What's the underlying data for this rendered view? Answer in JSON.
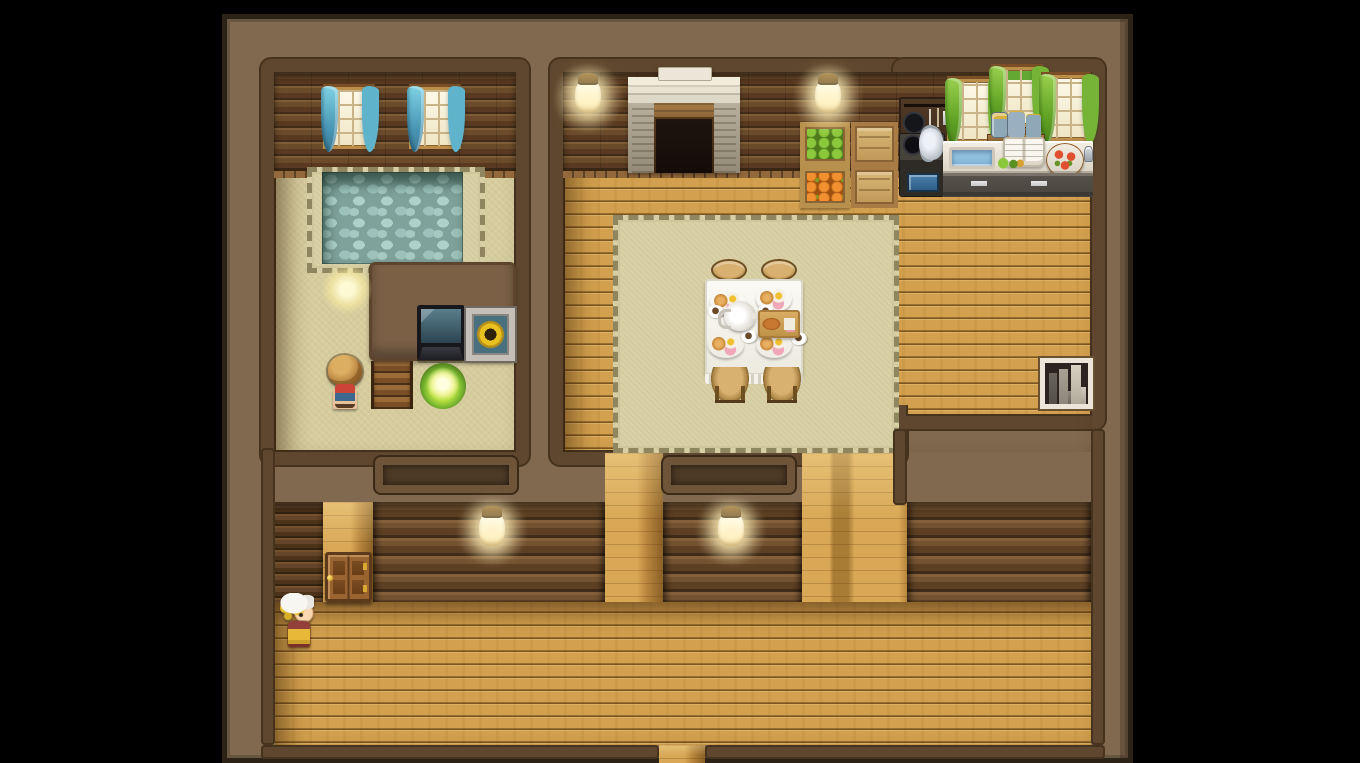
{
  "meta": {
    "app": "rpg-maker-style-game",
    "view": "cottage-interior-map",
    "visible_text": [],
    "hud": "none"
  },
  "palette": {
    "letterbox": "#000000",
    "wall_top": "#80694f",
    "room_border": "#5e472e",
    "log_wall": "#6b4b2a",
    "wood_floor": "#c9953f",
    "beige_floor": "#d6cc9e",
    "rug": "#d9d0a6",
    "pool_water": "#9cc2bb",
    "curtain_blue": "#5fb4cc",
    "curtain_green": "#76b438",
    "lamp_glow": "#ffeeb4",
    "fire": "#ff9820",
    "door_wood": "#9a6430",
    "tablecloth": "#f4f2ec"
  },
  "rooms": [
    {
      "name": "bath-living-room",
      "features": [
        "stone-pool",
        "blue-curtain-windows",
        "tv",
        "sunflower-picture",
        "stairs",
        "glowing-bush",
        "light-orb"
      ]
    },
    {
      "name": "dining-kitchen-room",
      "features": [
        "fireplace",
        "dining-table",
        "kitchen-counter",
        "produce-crates",
        "green-curtain-windows",
        "bookshelf"
      ]
    },
    {
      "name": "south-corridor",
      "features": [
        "wooden-door",
        "wall-lamps",
        "transom-openings",
        "exit-passage-south"
      ]
    }
  ],
  "objects": [
    {
      "name": "light-orb",
      "sprite": "glow-orb",
      "x": 94,
      "y": 244,
      "w": 52,
      "h": 52,
      "interactable": false
    },
    {
      "name": "window-blue-1",
      "sprite": "window-blue",
      "x": 96,
      "y": 68,
      "w": 52,
      "h": 62,
      "interactable": false
    },
    {
      "name": "window-blue-2",
      "sprite": "window-blue",
      "x": 182,
      "y": 68,
      "w": 52,
      "h": 62,
      "interactable": false
    },
    {
      "name": "tv",
      "sprite": "tv",
      "x": 190,
      "y": 286,
      "w": 48,
      "h": 55,
      "interactable": true
    },
    {
      "name": "sunflower-picture",
      "sprite": "picture",
      "x": 239,
      "y": 289,
      "w": 49,
      "h": 53,
      "interactable": false
    },
    {
      "name": "stairs-down",
      "sprite": "stairs",
      "x": 144,
      "y": 342,
      "w": 42,
      "h": 48,
      "interactable": true
    },
    {
      "name": "glowing-bush",
      "sprite": "bush-light",
      "x": 193,
      "y": 344,
      "w": 46,
      "h": 46,
      "interactable": false
    },
    {
      "name": "fireplace",
      "sprite": "fireplace",
      "x": 401,
      "y": 48,
      "w": 112,
      "h": 106,
      "interactable": false
    },
    {
      "name": "crate-apples",
      "sprite": "crate-apples",
      "x": 573,
      "y": 103,
      "w": 50,
      "h": 44,
      "interactable": false
    },
    {
      "name": "crate-plain-1",
      "sprite": "crate-wood",
      "x": 624,
      "y": 103,
      "w": 47,
      "h": 44,
      "interactable": false
    },
    {
      "name": "crate-carrots",
      "sprite": "crate-carrots",
      "x": 573,
      "y": 147,
      "w": 50,
      "h": 42,
      "interactable": false
    },
    {
      "name": "crate-plain-2",
      "sprite": "crate-wood",
      "x": 624,
      "y": 147,
      "w": 47,
      "h": 42,
      "interactable": false
    },
    {
      "name": "pot-rack",
      "sprite": "pot-rack",
      "x": 672,
      "y": 78,
      "w": 50,
      "h": 52,
      "interactable": false
    },
    {
      "name": "stove-with-kettle",
      "sprite": "stove",
      "x": 672,
      "y": 114,
      "w": 46,
      "h": 64,
      "interactable": false
    },
    {
      "name": "window-green-1",
      "sprite": "window-green",
      "x": 720,
      "y": 60,
      "w": 50,
      "h": 64,
      "interactable": false
    },
    {
      "name": "window-green-middle",
      "sprite": "window-green-high",
      "x": 764,
      "y": 48,
      "w": 52,
      "h": 60,
      "interactable": false
    },
    {
      "name": "window-green-2",
      "sprite": "window-green",
      "x": 814,
      "y": 56,
      "w": 50,
      "h": 66,
      "interactable": false
    },
    {
      "name": "jar-shelf",
      "sprite": "shelf-jars",
      "x": 760,
      "y": 86,
      "w": 58,
      "h": 40,
      "interactable": false
    },
    {
      "name": "kitchen-counter-top",
      "sprite": "counter-top",
      "x": 716,
      "y": 122,
      "w": 150,
      "h": 34,
      "interactable": false
    },
    {
      "name": "sink-basin",
      "sprite": "sink",
      "x": 722,
      "y": 128,
      "w": 46,
      "h": 22,
      "interactable": false
    },
    {
      "name": "open-cookbook",
      "sprite": "cookbook",
      "x": 776,
      "y": 118,
      "w": 42,
      "h": 30,
      "interactable": false
    },
    {
      "name": "veggie-plate",
      "sprite": "veggie-plate",
      "x": 766,
      "y": 138,
      "w": 34,
      "h": 14,
      "interactable": false
    },
    {
      "name": "pizza",
      "sprite": "pizza",
      "x": 819,
      "y": 124,
      "w": 38,
      "h": 34,
      "interactable": false
    },
    {
      "name": "salt-shaker",
      "sprite": "shaker",
      "x": 857,
      "y": 127,
      "w": 9,
      "h": 16,
      "interactable": false
    },
    {
      "name": "kitchen-counter-base",
      "sprite": "counter-base",
      "x": 716,
      "y": 154,
      "w": 150,
      "h": 24,
      "interactable": false
    },
    {
      "name": "stool-top-left",
      "sprite": "stool-top",
      "x": 484,
      "y": 240,
      "w": 36,
      "h": 22,
      "interactable": false
    },
    {
      "name": "stool-top-right",
      "sprite": "stool-top",
      "x": 534,
      "y": 240,
      "w": 36,
      "h": 22,
      "interactable": false
    },
    {
      "name": "dining-table",
      "sprite": "table-cloth",
      "x": 478,
      "y": 260,
      "w": 98,
      "h": 96,
      "interactable": true
    },
    {
      "name": "meal-plate-1",
      "sprite": "plate-meal",
      "x": 483,
      "y": 270,
      "w": 36,
      "h": 26,
      "interactable": false
    },
    {
      "name": "meal-plate-2",
      "sprite": "plate-meal",
      "x": 529,
      "y": 267,
      "w": 36,
      "h": 26,
      "interactable": false
    },
    {
      "name": "meal-plate-3",
      "sprite": "plate-meal",
      "x": 481,
      "y": 313,
      "w": 36,
      "h": 26,
      "interactable": false
    },
    {
      "name": "meal-plate-4",
      "sprite": "plate-meal",
      "x": 529,
      "y": 313,
      "w": 36,
      "h": 26,
      "interactable": false
    },
    {
      "name": "coffee-cup-1",
      "sprite": "cup",
      "x": 480,
      "y": 286,
      "w": 17,
      "h": 13,
      "interactable": false
    },
    {
      "name": "coffee-cup-2",
      "sprite": "cup",
      "x": 530,
      "y": 286,
      "w": 17,
      "h": 13,
      "interactable": false
    },
    {
      "name": "coffee-cup-3",
      "sprite": "cup",
      "x": 513,
      "y": 311,
      "w": 17,
      "h": 13,
      "interactable": false
    },
    {
      "name": "coffee-cup-4",
      "sprite": "cup",
      "x": 563,
      "y": 313,
      "w": 17,
      "h": 13,
      "interactable": false
    },
    {
      "name": "teapot",
      "sprite": "teapot",
      "x": 497,
      "y": 282,
      "w": 32,
      "h": 30,
      "interactable": false
    },
    {
      "name": "cutting-board-bread",
      "sprite": "cutting-board",
      "x": 531,
      "y": 291,
      "w": 42,
      "h": 28,
      "interactable": false
    },
    {
      "name": "stool-bottom-left",
      "sprite": "stool-bottom",
      "x": 484,
      "y": 348,
      "w": 38,
      "h": 36,
      "interactable": false
    },
    {
      "name": "stool-bottom-right",
      "sprite": "stool-bottom",
      "x": 536,
      "y": 348,
      "w": 38,
      "h": 36,
      "interactable": false
    },
    {
      "name": "bookshelf",
      "sprite": "bookshelf",
      "x": 813,
      "y": 339,
      "w": 53,
      "h": 51,
      "interactable": true
    },
    {
      "name": "wooden-door",
      "sprite": "door",
      "x": 98,
      "y": 533,
      "w": 47,
      "h": 50,
      "interactable": true
    },
    {
      "name": "wall-lamp-1",
      "sprite": "lamp",
      "x": 348,
      "y": 62,
      "w": 26,
      "h": 32,
      "interactable": false
    },
    {
      "name": "wall-lamp-2",
      "sprite": "lamp",
      "x": 588,
      "y": 62,
      "w": 26,
      "h": 32,
      "interactable": false
    },
    {
      "name": "wall-lamp-3",
      "sprite": "lamp",
      "x": 252,
      "y": 495,
      "w": 26,
      "h": 32,
      "interactable": false
    },
    {
      "name": "wall-lamp-4",
      "sprite": "lamp",
      "x": 491,
      "y": 495,
      "w": 26,
      "h": 32,
      "interactable": false
    },
    {
      "name": "npc-boy-brown-hair",
      "sprite": "char-boy",
      "x": 100,
      "y": 336,
      "w": 36,
      "h": 56,
      "interactable": true
    },
    {
      "name": "npc-girl-white-bonnet",
      "sprite": "char-girl",
      "x": 50,
      "y": 574,
      "w": 40,
      "h": 56,
      "interactable": true
    }
  ]
}
